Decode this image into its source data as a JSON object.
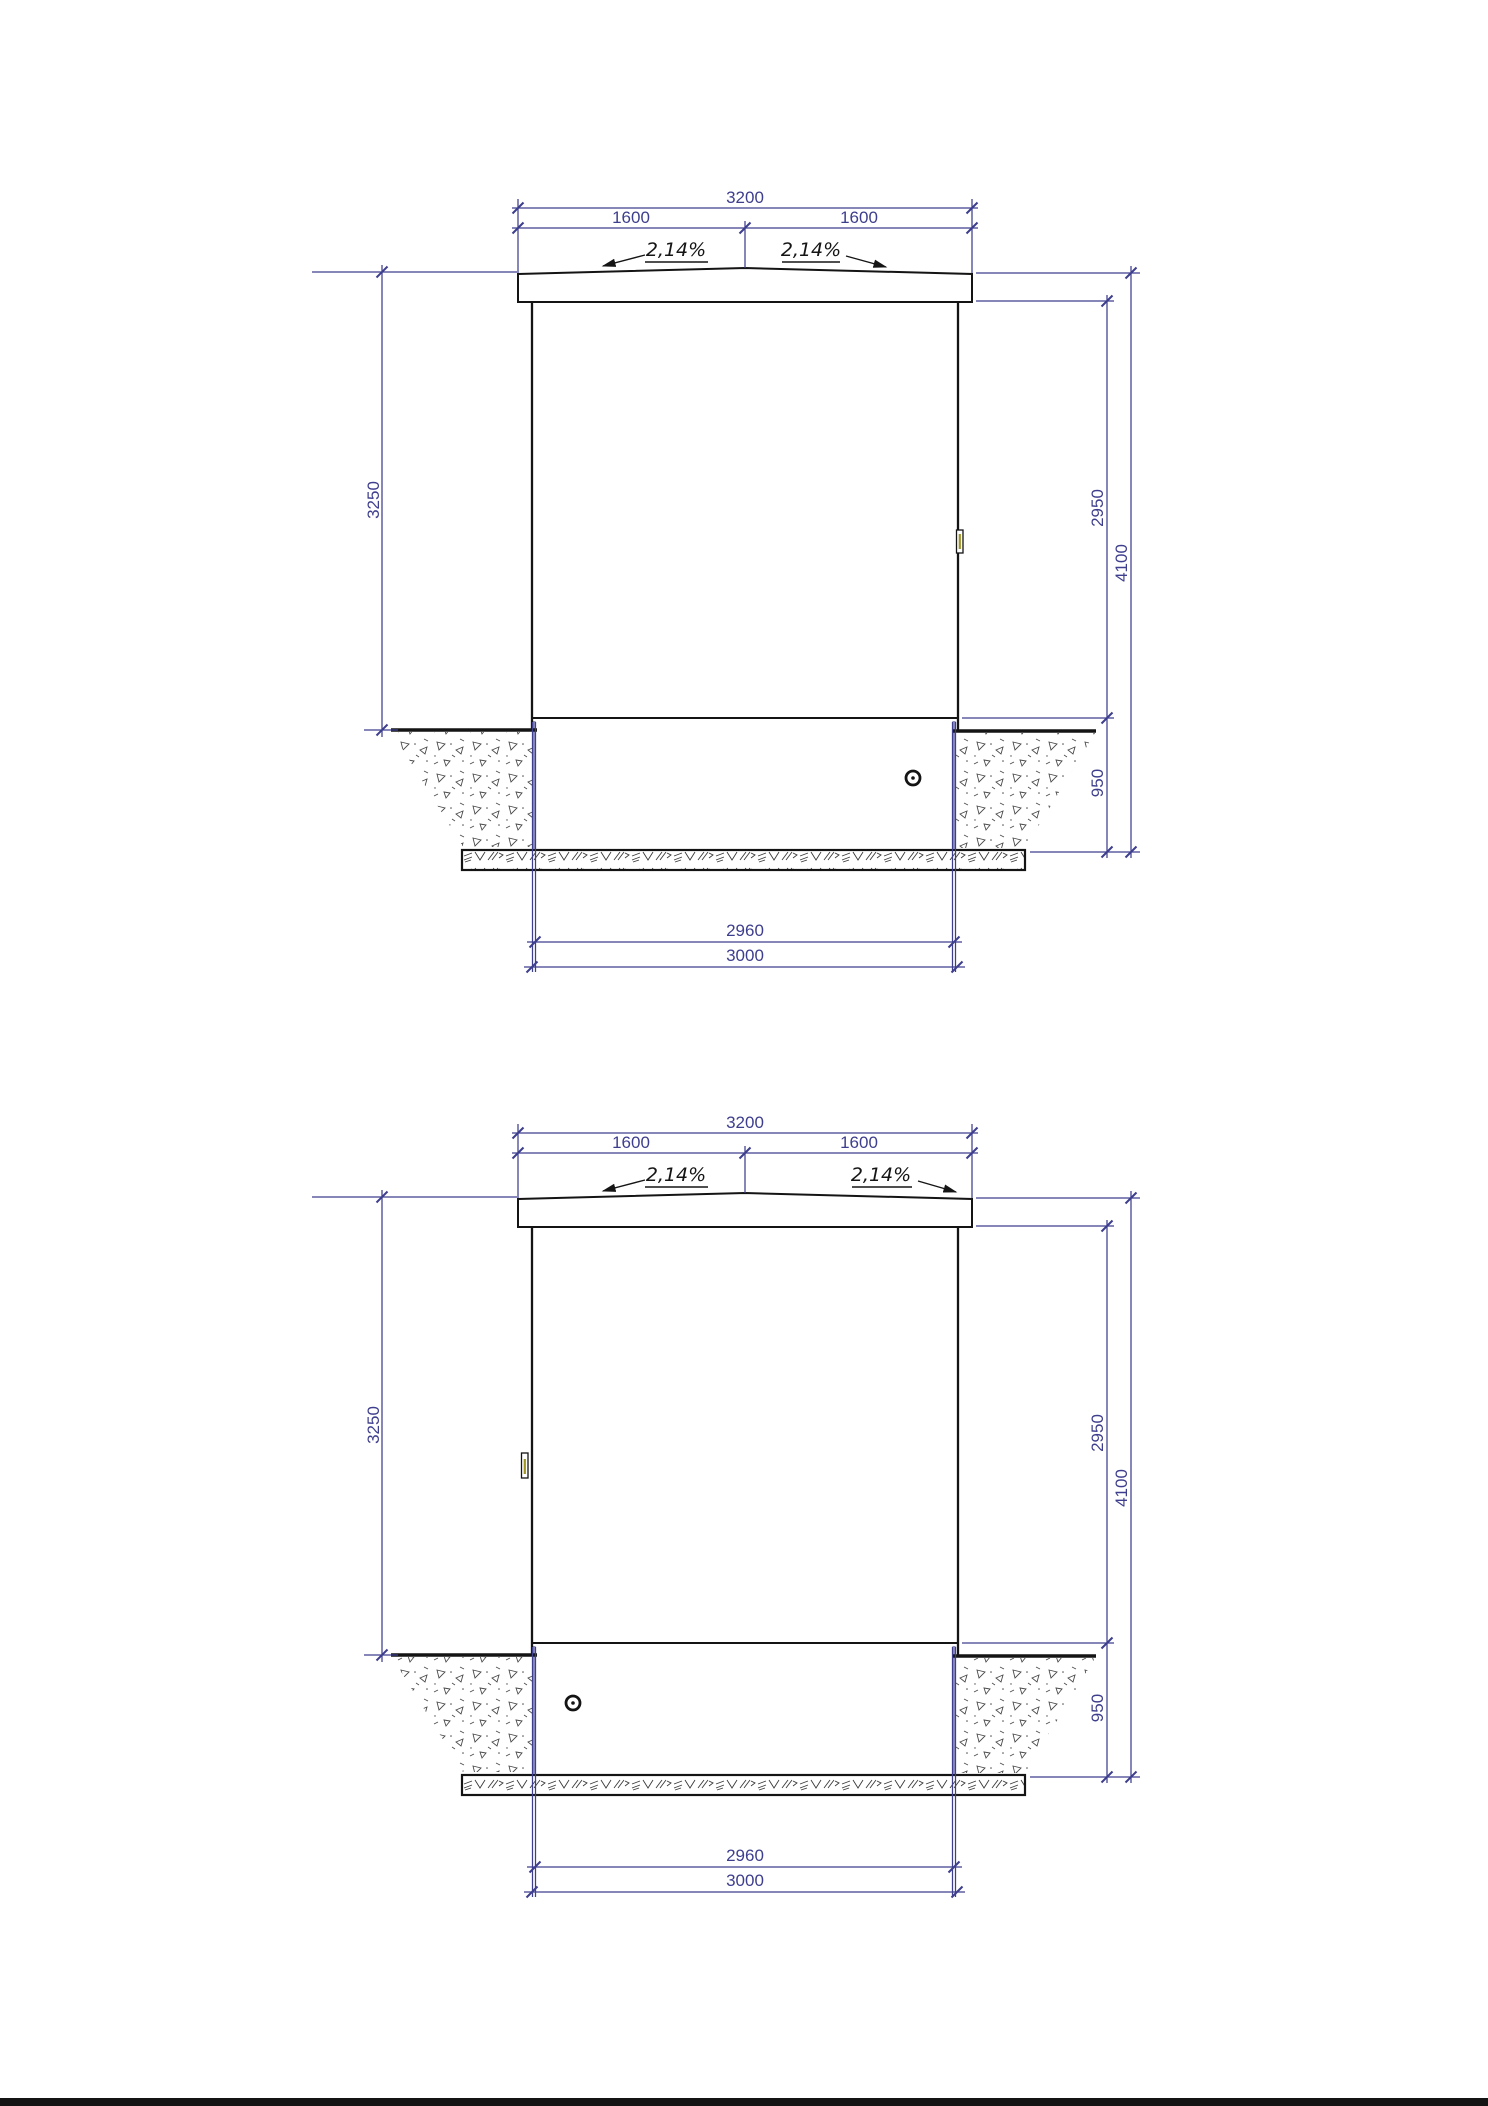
{
  "sheet": {
    "kind": "technical elevation drawing",
    "background": "#ffffff",
    "bottom_edge_bar_color": "#141414"
  },
  "colors": {
    "dimension_lines": "#3e3e8e",
    "drawing_lines": "#141414",
    "foundation_tint": "#8f8fbe"
  },
  "drawings": [
    {
      "position": "top",
      "dims": {
        "roof_width_total": "3200",
        "roof_half_left": "1600",
        "roof_half_right": "1600",
        "slope_left": "2,14%",
        "slope_right": "2,14%",
        "height_left": "3250",
        "height_wall_right": "2950",
        "height_overall": "4100",
        "foundation_depth": "950",
        "width_inner": "2960",
        "width_base": "3000"
      }
    },
    {
      "position": "bottom",
      "dims": {
        "roof_width_total": "3200",
        "roof_half_left": "1600",
        "roof_half_right": "1600",
        "slope_left": "2,14%",
        "slope_right": "2,14%",
        "height_left": "3250",
        "height_wall_right": "2950",
        "height_overall": "4100",
        "foundation_depth": "950",
        "width_inner": "2960",
        "width_base": "3000"
      }
    }
  ]
}
